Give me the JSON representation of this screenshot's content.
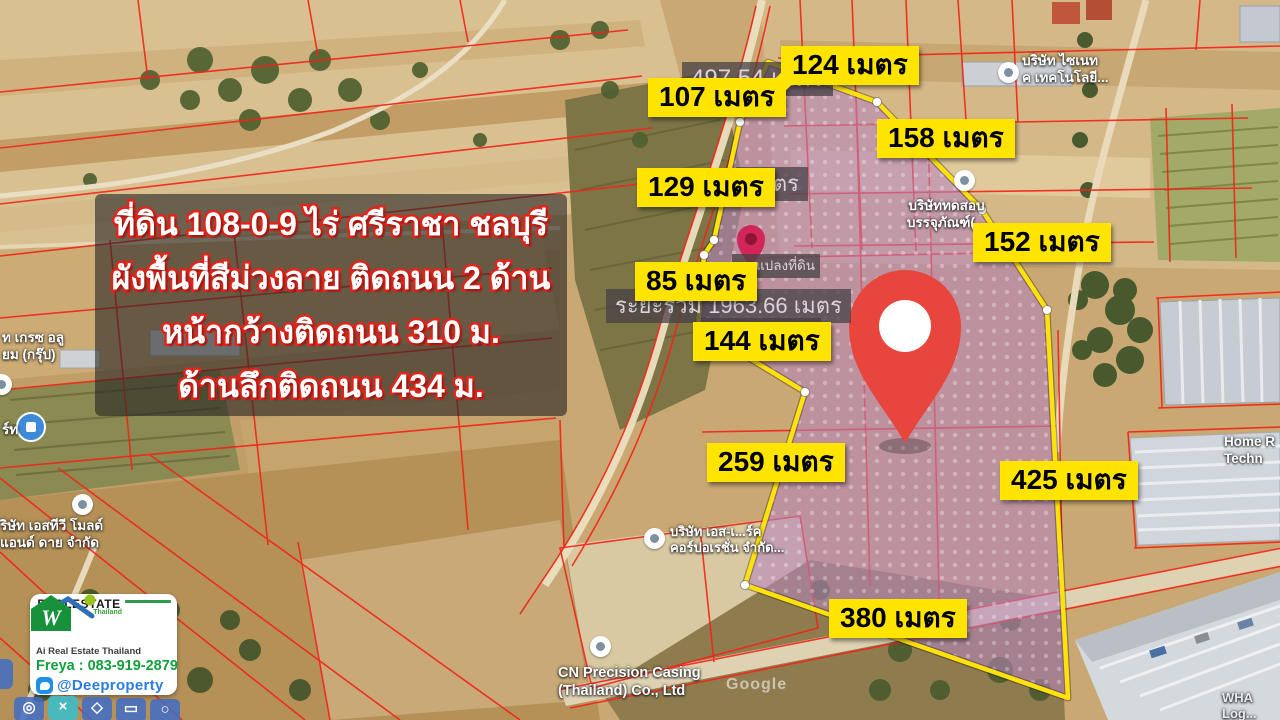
{
  "info_box": {
    "lines": [
      "ที่ดิน 108-0-9 ไร่ ศรีราชา ชลบุรี",
      "ผังพื้นที่สีม่วงลาย ติดถนน 2 ด้าน",
      "หน้ากว้างติดถนน 310 ม.",
      "ด้านลึกติดถนน 434 ม."
    ]
  },
  "measurements": [
    "107 เมตร",
    "124 เมตร",
    "158 เมตร",
    "129 เมตร",
    "152 เมตร",
    "85 เมตร",
    "144 เมตร",
    "259 เมตร",
    "425 เมตร",
    "380 เมตร"
  ],
  "map_badges": [
    "497.54 เมตร",
    "เมตร",
    "ผสานแปลงที่ดิน",
    "ระยะรวม 1963.66 เมตร"
  ],
  "pois": [
    {
      "line1": "บริษัท ไซเนท",
      "line2": "ค เทคโนโลยี..."
    },
    {
      "line1": "บริษัททดสอบ",
      "line2": "บรรจุภัณฑ์(..."
    },
    {
      "line1": "Home R",
      "line2": "Techn"
    },
    {
      "line1": "บริษัท เอส-เ...ร์ค",
      "line2": "คอร์ปอเรชั่น จำกัด..."
    },
    {
      "line1": "CN Precision Casing",
      "line2": "(Thailand) Co., Ltd"
    },
    {
      "line1": "ท เกรซ อลู",
      "line2": "ยม (กรุ๊ป)"
    },
    {
      "line1": "ร์ท",
      "line2": ""
    },
    {
      "line1": "ริษัท เอสทีวี โมลด์",
      "line2": "แอนด์ ดาย จำกัด"
    },
    {
      "line1": "WHA Log...",
      "line2": "1 (formerly..."
    }
  ],
  "watermark": "Google",
  "logo_card": {
    "brand": "REALESTATE",
    "brand_sub": "Thailand",
    "tagline": "Ai Real Estate Thailand",
    "phone": "Freya : 083-919-2879",
    "line_id": "@Deeproperty",
    "w_monogram": "W"
  },
  "map_tools": [
    {
      "name": "target-icon",
      "glyph": "◎"
    },
    {
      "name": "cut-icon",
      "glyph": "×"
    },
    {
      "name": "polygon-icon",
      "glyph": "◇"
    },
    {
      "name": "rectangle-icon",
      "glyph": "▭"
    },
    {
      "name": "circle-icon",
      "glyph": "○"
    }
  ],
  "colors": {
    "measurement_label_bg": "#ffe400",
    "boundary_yellow": "#ffe20a",
    "plot_fill_purple": "#b583bd",
    "pin_red": "#e8453c",
    "parcel_line_red": "#f32318",
    "info_text_stroke_red": "#e1251b",
    "phone_green": "#13a03c",
    "line_blue": "#2b7de0"
  }
}
